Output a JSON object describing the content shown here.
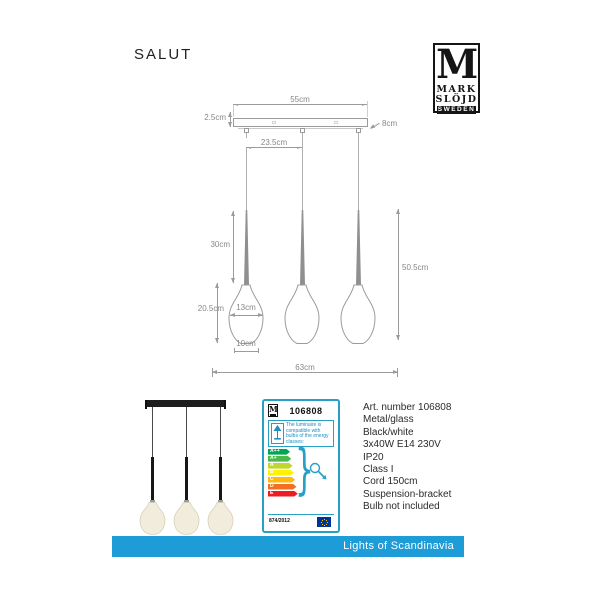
{
  "page": {
    "title": "SALUT"
  },
  "brand": {
    "monogram": "M",
    "name_line1": "MARK",
    "name_line2": "SLÖJD",
    "country": "SWEDEN"
  },
  "drawing": {
    "dimensions": {
      "plate_width": "55cm",
      "plate_height": "2.5cm",
      "plate_depth": "8cm",
      "cord_spacing": "23.5cm",
      "rod_length": "30cm",
      "drop_length": "50.5cm",
      "shade_height": "20.5cm",
      "shade_width": "13cm",
      "shade_bottom_width": "10cm",
      "total_width": "63cm"
    }
  },
  "energy_label": {
    "brand_monogram": "M",
    "article_number": "106808",
    "compatibility_text": "The luminaire is compatible with bulbs of the energy classes:",
    "classes": [
      {
        "label": "A++",
        "color": "#00a651"
      },
      {
        "label": "A+",
        "color": "#4db848"
      },
      {
        "label": "A",
        "color": "#bfd730"
      },
      {
        "label": "B",
        "color": "#fff200"
      },
      {
        "label": "C",
        "color": "#fdb913"
      },
      {
        "label": "D",
        "color": "#f37021"
      },
      {
        "label": "E",
        "color": "#ed1c24"
      }
    ],
    "regulation": "874/2012",
    "border_color": "#28a0c5"
  },
  "specifications": {
    "lines": [
      "Art. number 106808",
      "Metal/glass",
      "Black/white",
      "3x40W E14 230V",
      "IP20",
      "Class I",
      "Cord 150cm",
      "Suspension-bracket",
      "Bulb not included"
    ]
  },
  "footer": {
    "label": "Lights of Scandinavia",
    "color": "#1e9cd8"
  }
}
